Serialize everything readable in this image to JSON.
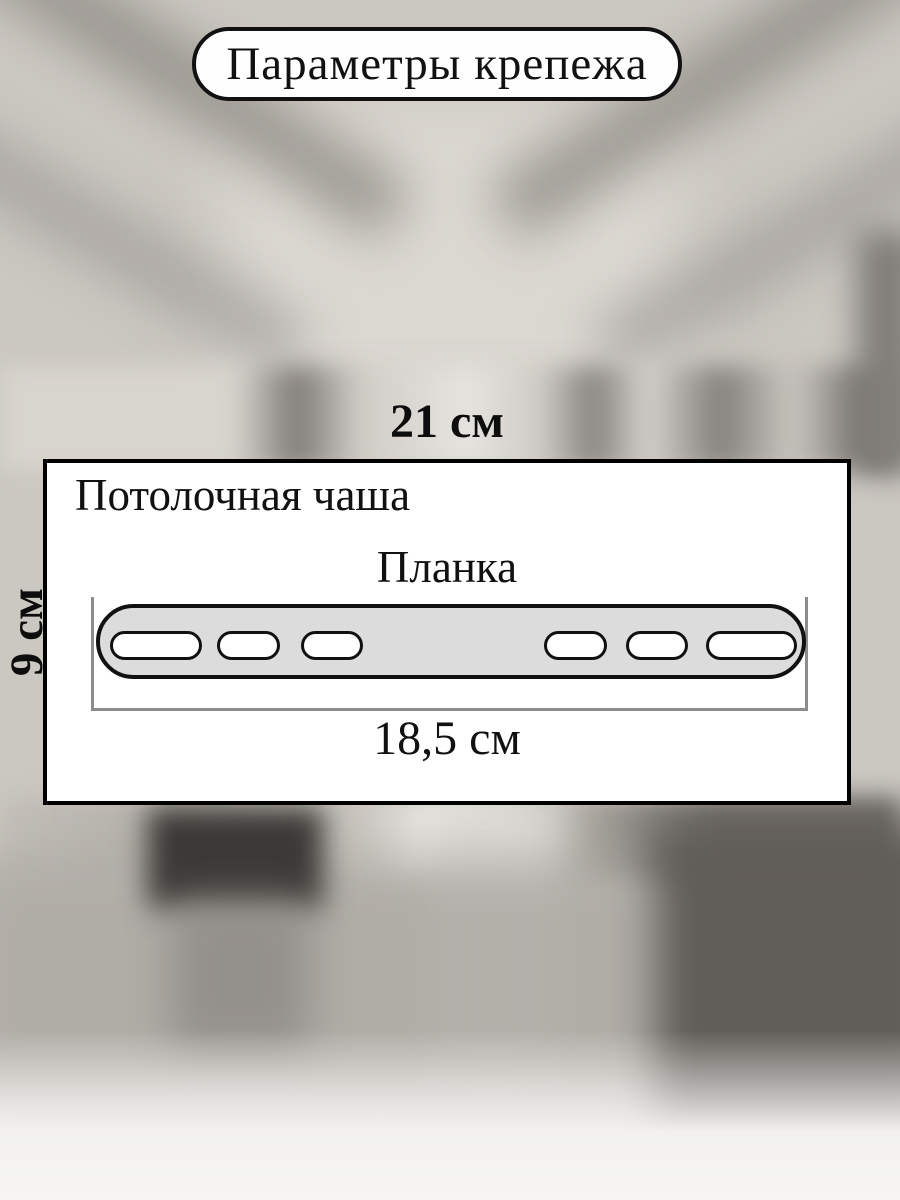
{
  "title": "Параметры крепежа",
  "labels": {
    "top_width": "21 см",
    "side_height": "9 см",
    "ceiling_cup": "Потолочная чаша",
    "plank": "Планка",
    "plank_width": "18,5 см"
  },
  "plank": {
    "slots": [
      {
        "left": 10,
        "width": 92
      },
      {
        "left": 117,
        "width": 63
      },
      {
        "left": 201,
        "width": 62
      },
      {
        "left": 444,
        "width": 63
      },
      {
        "left": 526,
        "width": 62
      },
      {
        "left": 606,
        "width": 91
      }
    ]
  },
  "colors": {
    "outline": "#111111",
    "plank_fill": "#dcdcdc",
    "slot_fill": "#ffffff",
    "bracket": "#8c8c8c",
    "panel_bg": "#ffffff"
  }
}
